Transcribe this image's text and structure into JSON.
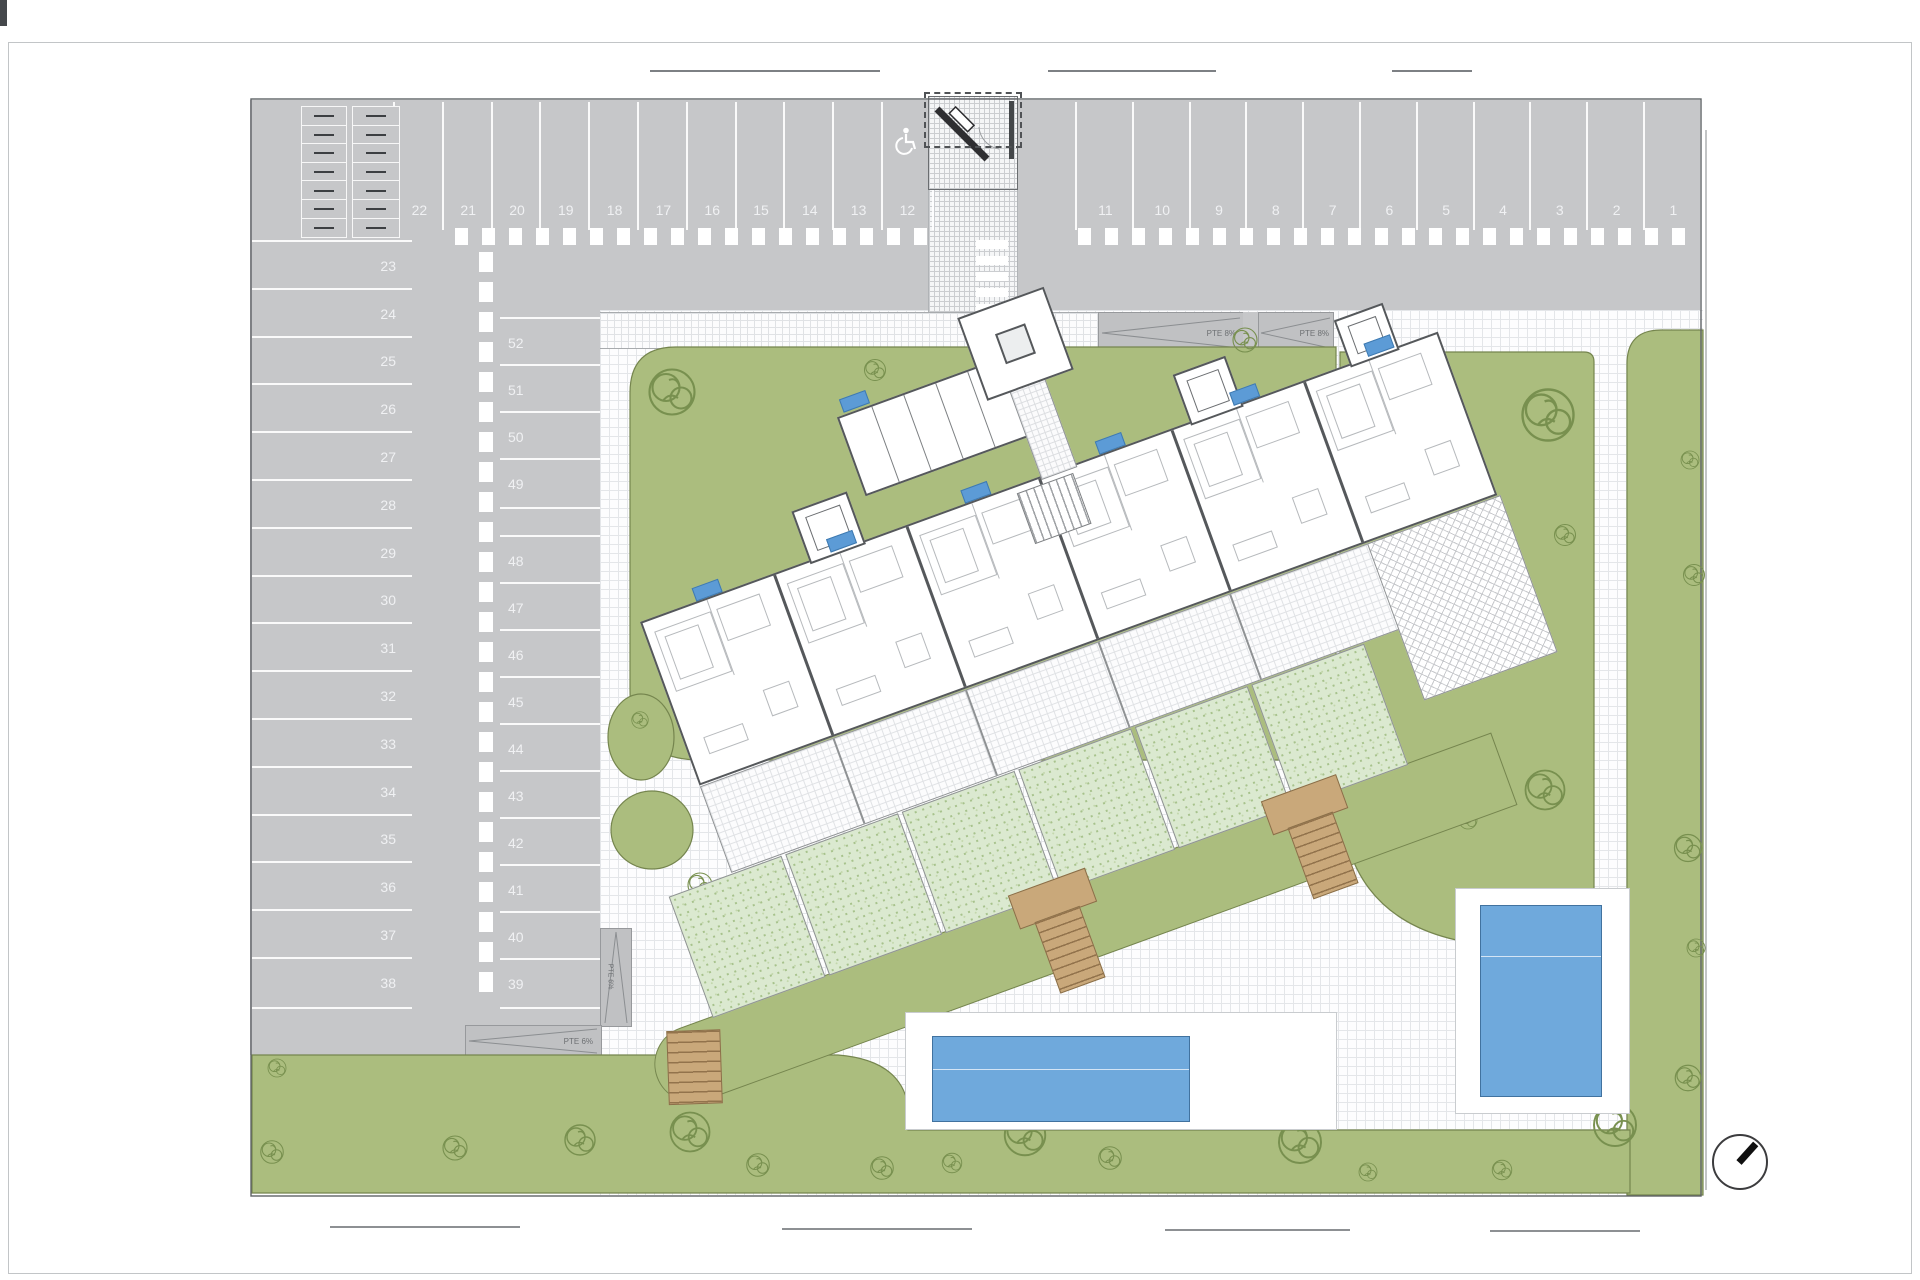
{
  "colors": {
    "asphalt": "#c6c7c9",
    "lawn": "#abbd7e",
    "lawn_line": "#75854e",
    "garden": "#dbe9d0",
    "plaza_line": "#e4e6e9",
    "pool": "#6fa9dc",
    "pool_edge": "#41729f",
    "wood": "#c9a87a",
    "wall": "#55585b",
    "unit_tag": "#5c9bd6",
    "marking": "#ffffff"
  },
  "parking": {
    "top_row_left": [
      "22",
      "21",
      "20",
      "19",
      "18",
      "17",
      "16",
      "15",
      "14",
      "13",
      "12"
    ],
    "top_row_right": [
      "11",
      "10",
      "9",
      "8",
      "7",
      "6",
      "5",
      "4",
      "3",
      "2",
      "1"
    ],
    "accessible_space": "12",
    "left_column": [
      "23",
      "24",
      "25",
      "26",
      "27",
      "28",
      "29",
      "30",
      "31",
      "32",
      "33",
      "34",
      "35",
      "36",
      "37",
      "38"
    ],
    "middle_column_upper": [
      "52",
      "51",
      "50",
      "49"
    ],
    "middle_column_lower": [
      "48",
      "47",
      "46",
      "45",
      "44",
      "43",
      "42",
      "41",
      "40",
      "39"
    ]
  },
  "ramps": {
    "top_a": {
      "label": "PTE 8%"
    },
    "top_b": {
      "label": "PTE 8%"
    },
    "side": {
      "label": "PTE 6%"
    },
    "bottom": {
      "label": "PTE 6%"
    }
  },
  "building": {
    "units": 6,
    "entrance_towers": 3,
    "storage_cells": 5,
    "unit_tags": 7
  },
  "landscape": {
    "pools": [
      {
        "x": 932,
        "y": 1036,
        "w": 256,
        "h": 84
      },
      {
        "x": 1480,
        "y": 905,
        "w": 120,
        "h": 190
      }
    ],
    "trees": [
      [
        672,
        392,
        1.5
      ],
      [
        875,
        370,
        0.7
      ],
      [
        1245,
        340,
        0.8
      ],
      [
        1548,
        415,
        1.7
      ],
      [
        1565,
        535,
        0.7
      ],
      [
        1545,
        790,
        1.3
      ],
      [
        1468,
        820,
        0.6
      ],
      [
        640,
        720,
        0.55
      ],
      [
        700,
        885,
        0.8
      ],
      [
        698,
        940,
        0.7
      ],
      [
        1690,
        460,
        0.6
      ],
      [
        1694,
        575,
        0.7
      ],
      [
        1688,
        848,
        0.9
      ],
      [
        1696,
        948,
        0.6
      ],
      [
        277,
        1068,
        0.6
      ],
      [
        272,
        1152,
        0.75
      ],
      [
        455,
        1148,
        0.8
      ],
      [
        580,
        1140,
        1.0
      ],
      [
        690,
        1132,
        1.3
      ],
      [
        758,
        1165,
        0.75
      ],
      [
        882,
        1168,
        0.75
      ],
      [
        952,
        1163,
        0.65
      ],
      [
        1025,
        1135,
        1.35
      ],
      [
        1110,
        1158,
        0.75
      ],
      [
        1300,
        1142,
        1.4
      ],
      [
        1368,
        1172,
        0.6
      ],
      [
        1502,
        1170,
        0.65
      ],
      [
        1615,
        1125,
        1.4
      ],
      [
        1688,
        1078,
        0.85
      ]
    ]
  },
  "compass": {
    "direction": "north-east"
  }
}
